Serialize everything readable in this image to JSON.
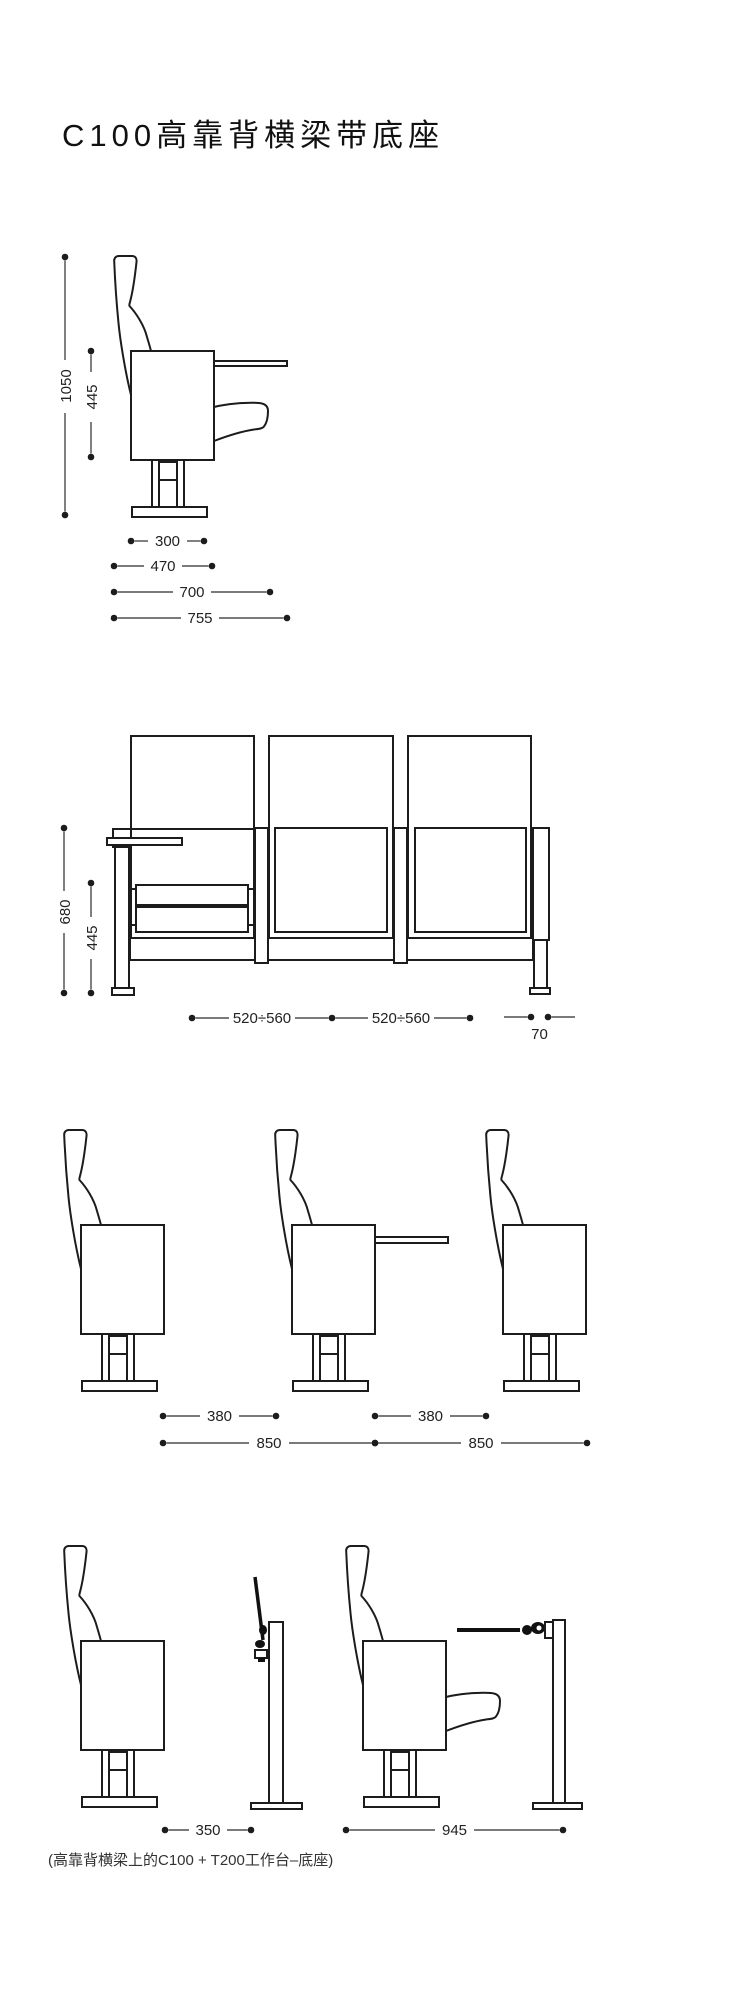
{
  "title": "C100高靠背横梁带底座",
  "caption": "(高靠背横梁上的C100 + T200工作台–底座)",
  "colors": {
    "line": "#1c1c1c",
    "dimension_text": "#222222",
    "background": "#ffffff"
  },
  "views": {
    "single_side": {
      "dims": {
        "total_height": "1050",
        "seat_height": "445",
        "base_width": "300",
        "seat_depth": "470",
        "depth_open": "700",
        "overall_depth": "755"
      }
    },
    "row_front": {
      "dims": {
        "beam_height": "680",
        "seat_height": "445",
        "seat_pitch_1": "520÷560",
        "seat_pitch_2": "520÷560",
        "end_offset": "70"
      }
    },
    "row_side": {
      "dims": {
        "clearance_1": "380",
        "clearance_2": "380",
        "row_pitch_1": "850",
        "row_pitch_2": "850"
      }
    },
    "workstation": {
      "dims": {
        "folded_distance": "350",
        "open_distance": "945"
      }
    }
  }
}
